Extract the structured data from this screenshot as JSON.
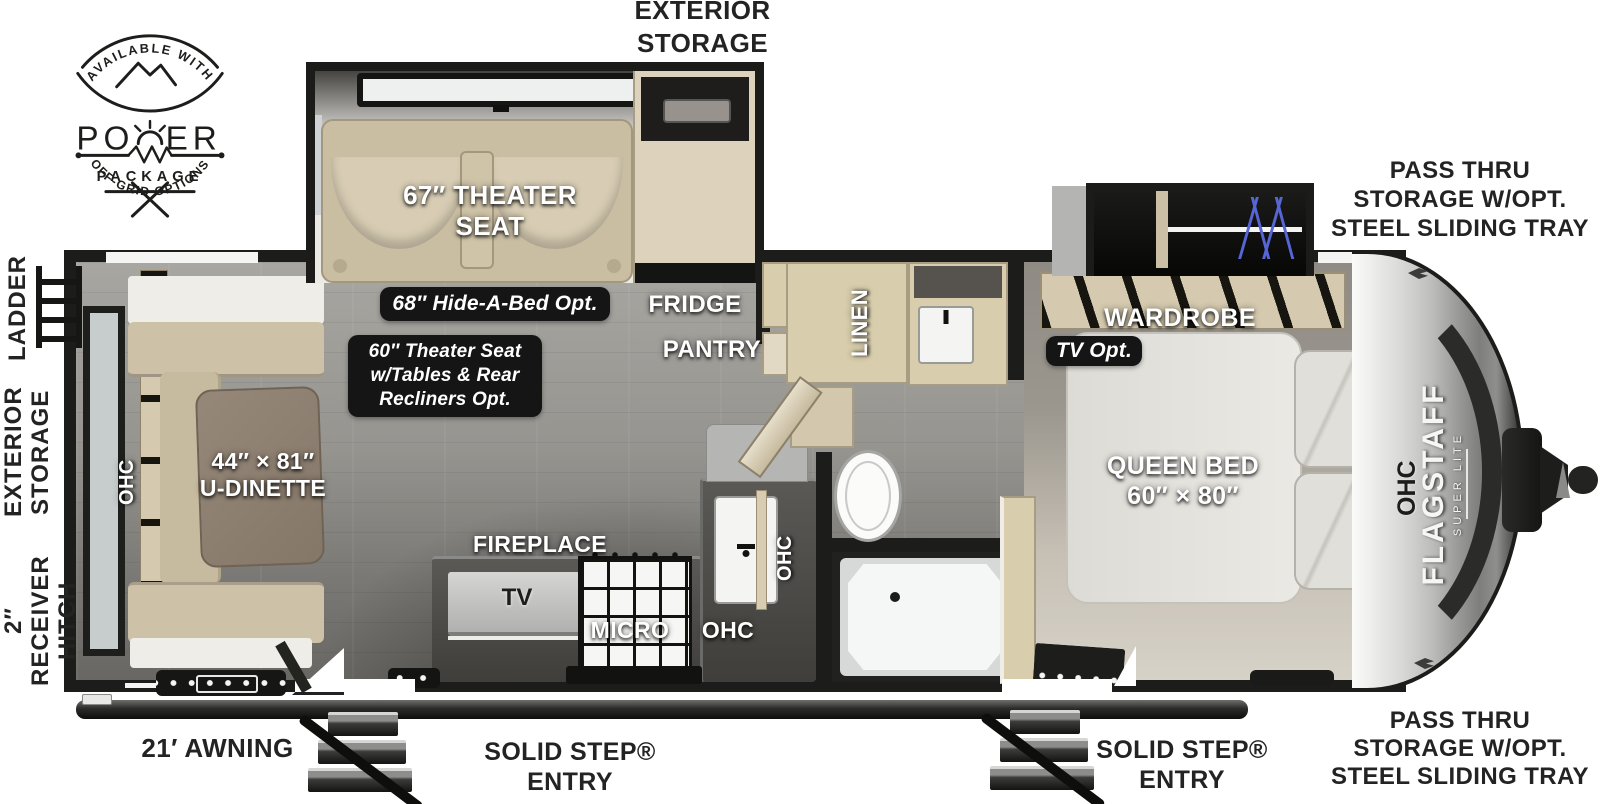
{
  "power_badge": {
    "arc_top": "AVAILABLE WITH",
    "word_left": "PO",
    "word_right": "ER",
    "package": "PACKAGE",
    "arc_bottom": "OFF-GRID OPTIONS"
  },
  "exterior_labels": {
    "top_storage": {
      "line1": "EXTERIOR",
      "line2": "STORAGE"
    },
    "pass_thru_top": {
      "line1": "PASS THRU",
      "line2": "STORAGE W/OPT.",
      "line3": "STEEL SLIDING TRAY"
    },
    "pass_thru_bottom": {
      "line1": "PASS THRU",
      "line2": "STORAGE W/OPT.",
      "line3": "STEEL SLIDING TRAY"
    },
    "ladder": "LADDER",
    "left_storage": {
      "line1": "EXTERIOR",
      "line2": "STORAGE"
    },
    "receiver_hitch": {
      "line1": "2″ RECEIVER",
      "line2": "HITCH"
    },
    "awning": "21′ AWNING",
    "entry_main": {
      "line1": "SOLID STEP®",
      "line2": "ENTRY"
    },
    "entry_bedroom": {
      "line1": "SOLID STEP®",
      "line2": "ENTRY"
    }
  },
  "room_labels": {
    "theater_seat": {
      "line1": "67″ THEATER",
      "line2": "SEAT"
    },
    "fridge": "FRIDGE",
    "pantry": "PANTRY",
    "linen": "LINEN",
    "wardrobe": "WARDROBE",
    "queen_bed": {
      "line1": "QUEEN BED",
      "line2": "60″ × 80″"
    },
    "u_dinette": {
      "line1": "44″ × 81″",
      "line2": "U-DINETTE"
    },
    "fireplace": "FIREPLACE",
    "tv": "TV",
    "micro": "MICRO",
    "ohc_dinette": "OHC",
    "ohc_sink": "OHC",
    "ohc_kitchen": "OHC",
    "ohc_bed": "OHC"
  },
  "option_badges": {
    "hide_a_bed": "68″ Hide-A-Bed Opt.",
    "theater_opt": {
      "line1": "60″ Theater Seat",
      "line2": "w/Tables & Rear",
      "line3": "Recliners Opt."
    },
    "tv_opt": "TV Opt."
  },
  "brand": {
    "name": "FLAGSTAFF",
    "sub": "SUPER LITE"
  },
  "colors": {
    "wall": "#1c1c1a",
    "cabinet_wood": "#d8cead",
    "floor_gray": "#96948f",
    "bedroom_floor": "#cfc9bf",
    "hanger_blue": "#5666d6",
    "badge_bg": "#151515",
    "label_dark": "#232323"
  }
}
